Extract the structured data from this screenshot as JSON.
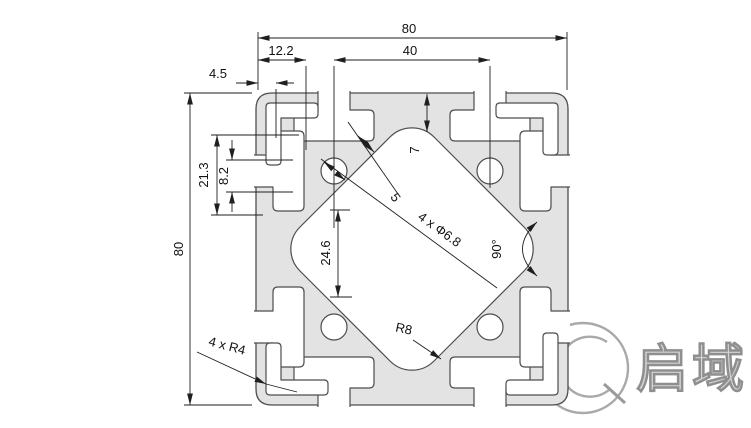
{
  "drawing": {
    "title": "80x80 aluminum extrusion profile cross-section",
    "dimensions": {
      "overall_width": "80",
      "overall_height": "80",
      "hole_spacing": "40",
      "slot_depth": "12.2",
      "wall_thickness": "4.5",
      "slot_inner_width": "21.3",
      "slot_opening": "8.2",
      "center_cavity_width": "24.6",
      "face_to_cavity": "7",
      "web_thickness": "5",
      "mounting_holes": "4 x Φ6.8",
      "web_angle": "90°",
      "cavity_fillet": "R8",
      "corner_radius": "4 x R4"
    },
    "logo": {
      "text": "启域"
    },
    "colors": {
      "profile_fill": "#e3e3e3",
      "edge_line": "#4d4d4d",
      "dimension_line": "#1f1f1f",
      "logo_gray": "#a9a9a9"
    }
  }
}
